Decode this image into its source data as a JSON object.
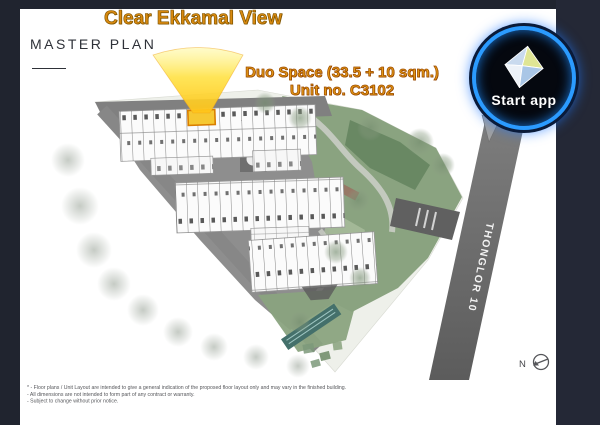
{
  "title": {
    "label": "MASTER PLAN"
  },
  "callouts": {
    "view_label": "Clear Ekkamal View",
    "unit_line1": "Duo Space (33.5 + 10 sqm.)",
    "unit_line2": "Unit no. C3102"
  },
  "start_button": {
    "label": "Start app",
    "icon": "diamond-gem-icon",
    "ring_color": "#2b9bff",
    "bg_color": "#05080f",
    "text_color": "#ffffff"
  },
  "map": {
    "road_label": "THONGLOR 10",
    "compass_label": "N",
    "highlighted_unit": "C3102",
    "colors": {
      "view_cone": "#ffd83a",
      "unit_highlight": "#f6c832",
      "road": "#6e6e6e",
      "podium": "#8e8e8e",
      "garden": "#8aa380",
      "frame": "#20242f",
      "callout_orange": "#d8890f"
    }
  },
  "disclaimer": {
    "line1": "* - Floor plans / Unit Layout are intended to give a general indication of the proposed floor layout only and may vary in the finished building.",
    "line2": "- All dimensions are not intended to form part of any contract or warranty.",
    "line3": "- Subject to change without prior notice."
  }
}
